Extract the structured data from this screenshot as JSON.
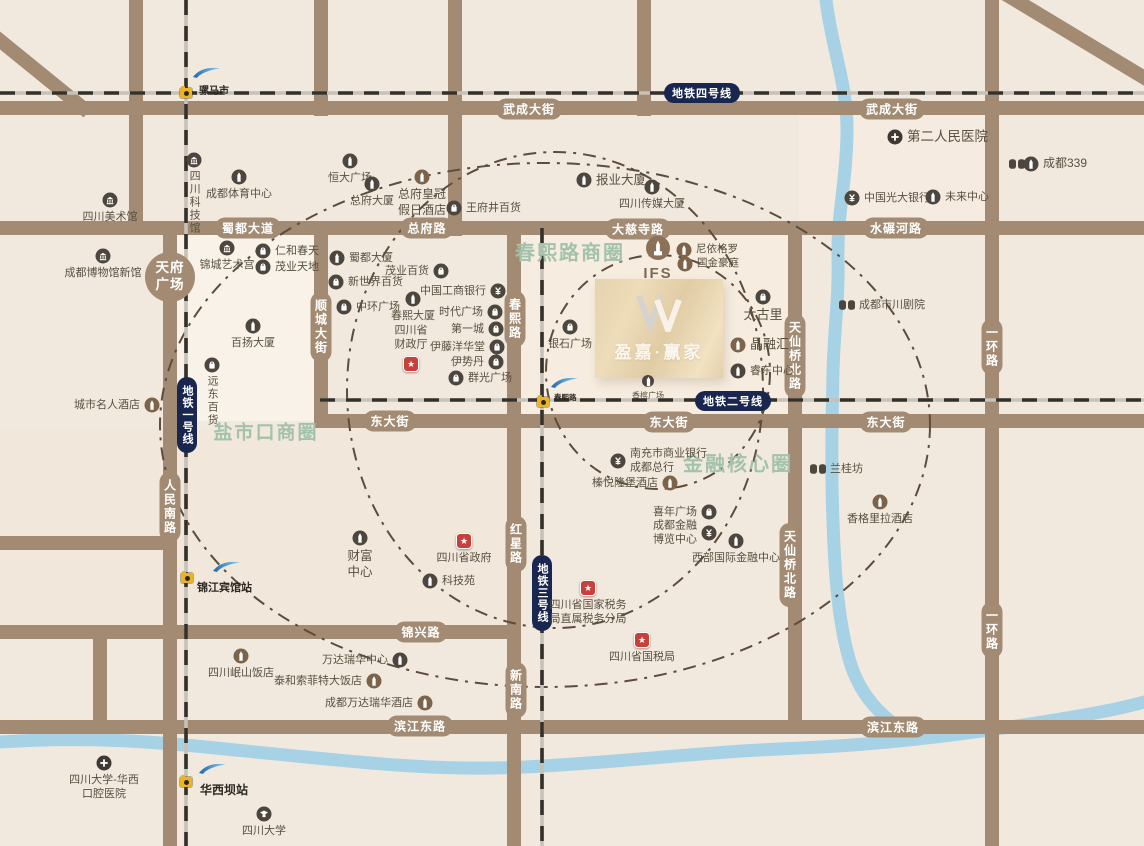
{
  "map": {
    "bg": "#f2e9de",
    "road_color": "#a28b72",
    "river_color": "#a7d2e6",
    "metro_base": "#c7c1b7",
    "metro_dash": "#34302a",
    "ring_color": "#5d4c3b",
    "metro_pill_bg": "#192750",
    "zone_color": "#a2c2ab",
    "label_color": "#57503f",
    "tints": [
      {
        "x": 170,
        "y": 235,
        "w": 144,
        "h": 186,
        "c": "rgba(255,252,245,0.45)"
      },
      {
        "x": 521,
        "y": 235,
        "w": 274,
        "h": 180,
        "c": "rgba(250,238,224,0.55)"
      },
      {
        "x": 799,
        "y": 115,
        "w": 186,
        "h": 106,
        "c": "rgba(248,236,226,0.55)"
      },
      {
        "x": 0,
        "y": 428,
        "w": 507,
        "h": 204,
        "c": "rgba(240,230,216,0.5)"
      }
    ]
  },
  "roads": {
    "segments": [
      [
        0,
        108,
        1144,
        108
      ],
      [
        0,
        228,
        1144,
        228
      ],
      [
        314,
        421,
        1144,
        421
      ],
      [
        0,
        543,
        177,
        543
      ],
      [
        0,
        632,
        521,
        632
      ],
      [
        0,
        727,
        1144,
        727
      ],
      [
        136,
        0,
        136,
        235
      ],
      [
        170,
        228,
        170,
        846
      ],
      [
        321,
        0,
        321,
        116
      ],
      [
        321,
        221,
        321,
        428
      ],
      [
        455,
        0,
        455,
        236
      ],
      [
        514,
        221,
        514,
        846
      ],
      [
        644,
        0,
        644,
        116
      ],
      [
        795,
        221,
        795,
        734
      ],
      [
        992,
        0,
        992,
        846
      ],
      [
        100,
        632,
        100,
        734
      ],
      [
        -8,
        34,
        88,
        112
      ],
      [
        1002,
        -8,
        1148,
        80
      ]
    ]
  },
  "road_labels": [
    {
      "t": "武成大街",
      "x": 529,
      "y": 109
    },
    {
      "t": "武成大街",
      "x": 892,
      "y": 109
    },
    {
      "t": "蜀都大道",
      "x": 248,
      "y": 228
    },
    {
      "t": "总府路",
      "x": 427,
      "y": 228
    },
    {
      "t": "大慈寺路",
      "x": 638,
      "y": 229
    },
    {
      "t": "水碾河路",
      "x": 896,
      "y": 228
    },
    {
      "t": "东大街",
      "x": 390,
      "y": 421
    },
    {
      "t": "东大街",
      "x": 669,
      "y": 422
    },
    {
      "t": "东大街",
      "x": 886,
      "y": 422
    },
    {
      "t": "锦兴路",
      "x": 421,
      "y": 632
    },
    {
      "t": "滨江东路",
      "x": 420,
      "y": 726
    },
    {
      "t": "滨江东路",
      "x": 893,
      "y": 727
    },
    {
      "t": "顺城大街",
      "x": 321,
      "y": 327,
      "v": 1
    },
    {
      "t": "春熙路",
      "x": 515,
      "y": 319,
      "v": 1
    },
    {
      "t": "红星路",
      "x": 516,
      "y": 544,
      "v": 1
    },
    {
      "t": "新南路",
      "x": 516,
      "y": 690,
      "v": 1
    },
    {
      "t": "人民南路",
      "x": 170,
      "y": 507,
      "v": 1
    },
    {
      "t": "天仙桥北路",
      "x": 795,
      "y": 356,
      "v": 1
    },
    {
      "t": "天仙桥北路",
      "x": 790,
      "y": 565,
      "v": 1
    },
    {
      "t": "一环路",
      "x": 992,
      "y": 347,
      "v": 1
    },
    {
      "t": "一环路",
      "x": 992,
      "y": 630,
      "v": 1
    }
  ],
  "plaza": {
    "label": "天府\n广场",
    "x": 170,
    "y": 277,
    "d": 50
  },
  "zones": [
    {
      "label": "春熙路商圈",
      "x": 570,
      "y": 251,
      "size": 20
    },
    {
      "label": "盐市口商圈",
      "x": 266,
      "y": 431,
      "size": 19
    },
    {
      "label": "金融核心圈",
      "x": 738,
      "y": 462,
      "size": 20
    }
  ],
  "rings": [
    {
      "cx": 545,
      "cy": 425,
      "rx": 385,
      "ry": 262
    },
    {
      "cx": 555,
      "cy": 390,
      "rx": 208,
      "ry": 238
    },
    {
      "cx": 658,
      "cy": 372,
      "rx": 112,
      "ry": 117
    }
  ],
  "rivers": [
    "M826 0 C832 50 848 85 847 135 C846 185 837 215 838 258 C839 300 834 330 833 372 C832 420 831 470 833 522 C835 580 839 625 850 662 C860 695 880 716 908 734",
    "M0 742 C90 736 160 742 235 750 C340 760 430 772 525 767 C625 762 700 752 800 748 C905 744 1010 728 1090 714 C1112 710 1130 706 1144 702"
  ],
  "metro": {
    "lines": [
      {
        "name": "metro-line-4",
        "pts": [
          0,
          93,
          1144,
          93
        ]
      },
      {
        "name": "metro-line-1",
        "pts": [
          186,
          0,
          186,
          846
        ]
      },
      {
        "name": "metro-line-2",
        "pts": [
          320,
          400,
          1144,
          400
        ]
      },
      {
        "name": "metro-line-3",
        "pts": [
          542,
          228,
          542,
          846
        ]
      }
    ],
    "pills": [
      {
        "label": "地铁四号线",
        "x": 702,
        "y": 93,
        "vert": false
      },
      {
        "label": "地铁一号线",
        "x": 187,
        "y": 415,
        "vert": true
      },
      {
        "label": "地铁二号线",
        "x": 733,
        "y": 401,
        "vert": false
      },
      {
        "label": "地铁三号线",
        "x": 542,
        "y": 593,
        "vert": true
      }
    ],
    "stations": [
      {
        "name": "骡马市",
        "cam": [
          186,
          93
        ],
        "wave": [
          192,
          66
        ],
        "lx": 199,
        "ly": 82,
        "size": 10
      },
      {
        "name": "春熙路",
        "cam": [
          543,
          402
        ],
        "wave": [
          550,
          376
        ],
        "lx": 554,
        "ly": 392,
        "size": 7.5
      },
      {
        "name": "锦江宾馆站",
        "cam": [
          187,
          578
        ],
        "wave": [
          212,
          560
        ],
        "lx": 197,
        "ly": 579,
        "size": 11
      },
      {
        "name": "华西坝站",
        "cam": [
          186,
          782
        ],
        "wave": [
          198,
          762
        ],
        "lx": 200,
        "ly": 781,
        "size": 12
      }
    ]
  },
  "property": {
    "name": "盈嘉·赢家",
    "logo": "W-monogram",
    "x": 595,
    "y": 279,
    "w": 128,
    "h": 99
  },
  "pois": [
    {
      "label": "四川科技馆",
      "icon": "museum",
      "x": 194,
      "y": 160,
      "lpos": "vbelow"
    },
    {
      "label": "成都体育中心",
      "icon": "building",
      "x": 239,
      "y": 177,
      "lpos": "below"
    },
    {
      "label": "四川美术馆",
      "icon": "museum",
      "x": 110,
      "y": 200,
      "lpos": "below"
    },
    {
      "label": "成都博物馆新馆",
      "icon": "museum",
      "x": 103,
      "y": 256,
      "lpos": "below"
    },
    {
      "label": "恒大广场",
      "icon": "building",
      "x": 350,
      "y": 161,
      "lpos": "below"
    },
    {
      "label": "总府大厦",
      "icon": "building",
      "x": 372,
      "y": 184,
      "lpos": "below"
    },
    {
      "label": "总府皇冠\n假日酒店",
      "icon": "hotel",
      "x": 422,
      "y": 177,
      "lpos": "below",
      "size": 12
    },
    {
      "label": "王府井百货",
      "icon": "shop",
      "x": 454,
      "y": 208,
      "lpos": "right"
    },
    {
      "label": "报业大厦",
      "icon": "building",
      "x": 584,
      "y": 180,
      "lpos": "right",
      "size": 12.5
    },
    {
      "label": "四川传媒大厦",
      "icon": "building",
      "x": 652,
      "y": 187,
      "lpos": "below"
    },
    {
      "label": "第二人民医院",
      "icon": "hospital",
      "x": 895,
      "y": 137,
      "lpos": "right",
      "size": 13.5
    },
    {
      "label": "成都339",
      "icon": "masks",
      "icon2": "building",
      "x": 1017,
      "y": 164,
      "lpos": "right2",
      "size": 12
    },
    {
      "label": "中国光大银行",
      "icon": "bank",
      "x": 852,
      "y": 198,
      "lpos": "right"
    },
    {
      "label": "未来中心",
      "icon": "building",
      "x": 933,
      "y": 197,
      "lpos": "right"
    },
    {
      "label": "锦城艺术宫",
      "icon": "museum",
      "x": 227,
      "y": 248,
      "lpos": "below"
    },
    {
      "label": "仁和春天",
      "icon": "shop",
      "x": 263,
      "y": 251,
      "lpos": "right"
    },
    {
      "label": "茂业天地",
      "icon": "shop",
      "x": 263,
      "y": 267,
      "lpos": "right"
    },
    {
      "label": "蜀都大厦",
      "icon": "building",
      "x": 337,
      "y": 258,
      "lpos": "right"
    },
    {
      "label": "新世界百货",
      "icon": "shop",
      "x": 336,
      "y": 282,
      "lpos": "right"
    },
    {
      "label": "茂业百货",
      "icon": "shop",
      "x": 441,
      "y": 271,
      "lpos": "left"
    },
    {
      "label": "中国工商银行",
      "icon": "bank",
      "x": 498,
      "y": 291,
      "lpos": "left"
    },
    {
      "label": "春熙大厦",
      "icon": "building",
      "x": 413,
      "y": 299,
      "lpos": "below"
    },
    {
      "label": "中环广场",
      "icon": "shop",
      "x": 344,
      "y": 307,
      "lpos": "right"
    },
    {
      "label": "时代广场",
      "icon": "shop",
      "x": 495,
      "y": 312,
      "lpos": "left"
    },
    {
      "label": "第一城",
      "icon": "shop",
      "x": 496,
      "y": 329,
      "lpos": "left"
    },
    {
      "label": "伊藤洋华堂",
      "icon": "shop",
      "x": 497,
      "y": 347,
      "lpos": "left"
    },
    {
      "label": "伊势丹",
      "icon": "shop",
      "x": 496,
      "y": 362,
      "lpos": "left"
    },
    {
      "label": "群光广场",
      "icon": "shop",
      "x": 456,
      "y": 378,
      "lpos": "right"
    },
    {
      "label": "百扬大厦",
      "icon": "building",
      "x": 253,
      "y": 326,
      "lpos": "below"
    },
    {
      "label": "四川省\n财政厅",
      "icon": "gov",
      "x": 411,
      "y": 364,
      "lpos": "above"
    },
    {
      "label": "远东百货",
      "icon": "shop",
      "x": 212,
      "y": 365,
      "lpos": "vbelow"
    },
    {
      "label": "城市名人酒店",
      "icon": "hotel",
      "x": 152,
      "y": 405,
      "lpos": "left"
    },
    {
      "label": "IFS",
      "icon": "ifs",
      "x": 658,
      "y": 248,
      "lpos": "below",
      "cls": "ifslbl"
    },
    {
      "label": "尼依格罗",
      "icon": "hotel",
      "x": 684,
      "y": 250,
      "lpos": "right",
      "size": 10.5
    },
    {
      "label": "国金豪庭",
      "icon": "hotel",
      "x": 685,
      "y": 264,
      "lpos": "right",
      "size": 10.5
    },
    {
      "label": "银石广场",
      "icon": "shop",
      "x": 570,
      "y": 327,
      "lpos": "below"
    },
    {
      "label": "太古里",
      "icon": "shop",
      "x": 763,
      "y": 297,
      "lpos": "below",
      "size": 13
    },
    {
      "label": "晶融汇",
      "icon": "hotel",
      "x": 738,
      "y": 345,
      "lpos": "right",
      "size": 13
    },
    {
      "label": "睿东中心",
      "icon": "building",
      "x": 738,
      "y": 371,
      "lpos": "right"
    },
    {
      "label": "香槟广场",
      "icon": "building",
      "x": 648,
      "y": 381,
      "lpos": "below",
      "size": 8,
      "small": true
    },
    {
      "label": "成都市川剧院",
      "icon": "masks",
      "x": 847,
      "y": 305,
      "lpos": "right"
    },
    {
      "label": "兰桂坊",
      "icon": "masks",
      "x": 818,
      "y": 469,
      "lpos": "right"
    },
    {
      "label": "香格里拉酒店",
      "icon": "hotel",
      "x": 880,
      "y": 502,
      "lpos": "below"
    },
    {
      "label": "南充市商业银行\n成都总行",
      "icon": "bank",
      "x": 618,
      "y": 461,
      "lpos": "right",
      "align": "left"
    },
    {
      "label": "榛悦隆堡酒店",
      "icon": "hotel",
      "x": 670,
      "y": 483,
      "lpos": "left"
    },
    {
      "label": "喜年广场",
      "icon": "shop",
      "x": 709,
      "y": 512,
      "lpos": "left"
    },
    {
      "label": "成都金融\n博览中心",
      "icon": "bank",
      "x": 709,
      "y": 533,
      "lpos": "left"
    },
    {
      "label": "西部国际金融中心",
      "icon": "building",
      "x": 736,
      "y": 541,
      "lpos": "below"
    },
    {
      "label": "四川省国家税务\n局直属税务分局",
      "icon": "gov",
      "x": 588,
      "y": 588,
      "lpos": "below",
      "align": "left"
    },
    {
      "label": "四川省国税局",
      "icon": "gov",
      "x": 642,
      "y": 640,
      "lpos": "below"
    },
    {
      "label": "财富\n中心",
      "icon": "building",
      "x": 360,
      "y": 538,
      "lpos": "below",
      "size": 12.5
    },
    {
      "label": "四川省政府",
      "icon": "gov",
      "x": 464,
      "y": 541,
      "lpos": "below"
    },
    {
      "label": "科技苑",
      "icon": "building",
      "x": 430,
      "y": 581,
      "lpos": "right"
    },
    {
      "label": "万达瑞华中心",
      "icon": "building",
      "x": 400,
      "y": 660,
      "lpos": "left"
    },
    {
      "label": "四川岷山饭店",
      "icon": "hotel",
      "x": 241,
      "y": 656,
      "lpos": "below"
    },
    {
      "label": "泰和索菲特大饭店",
      "icon": "hotel",
      "x": 374,
      "y": 681,
      "lpos": "left"
    },
    {
      "label": "成都万达瑞华酒店",
      "icon": "hotel",
      "x": 425,
      "y": 703,
      "lpos": "left"
    },
    {
      "label": "四川大学-华西\n口腔医院",
      "icon": "hospital",
      "x": 104,
      "y": 763,
      "lpos": "below"
    },
    {
      "label": "四川大学",
      "icon": "school",
      "x": 264,
      "y": 814,
      "lpos": "below"
    }
  ]
}
